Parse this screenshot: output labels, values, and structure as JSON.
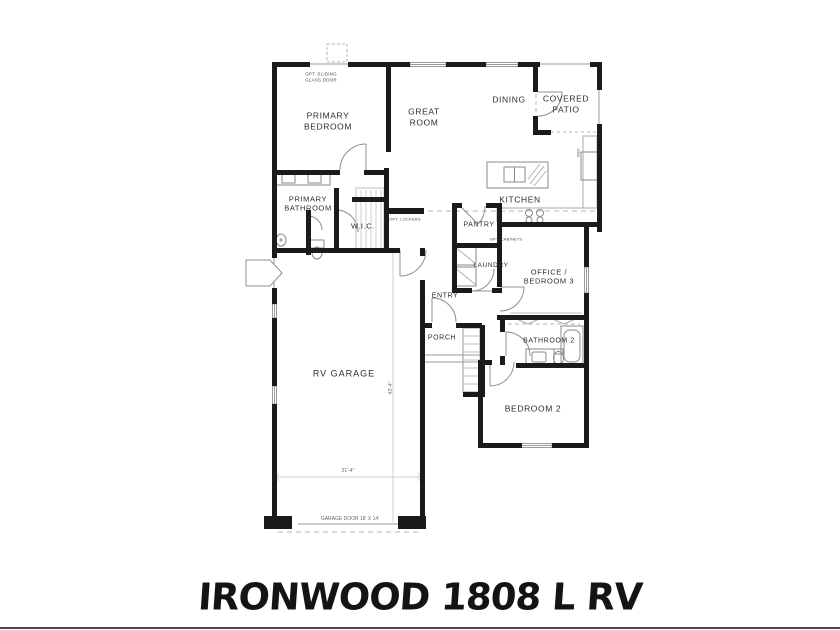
{
  "title": "IRONWOOD 1808 L RV",
  "rooms": {
    "primary_bedroom": "PRIMARY\nBEDROOM",
    "great_room": "GREAT\nROOM",
    "dining": "DINING",
    "covered_patio": "COVERED\nPATIO",
    "kitchen": "KITCHEN",
    "primary_bathroom": "PRIMARY\nBATHROOM",
    "wic": "W.I.C.",
    "pantry": "PANTRY",
    "laundry": "LAUNDRY",
    "office_bedroom3": "OFFICE /\nBEDROOM 3",
    "entry": "ENTRY",
    "porch": "PORCH",
    "bathroom2": "BATHROOM 2",
    "bedroom2": "BEDROOM 2",
    "rv_garage": "RV GARAGE"
  },
  "annotations": {
    "opt_sliding_glass_door": "OPT. SLIDING\nGLASS DOOR",
    "opt_lockers": "OPT. LOCKERS",
    "opt_cabinets": "OPT. CABINETS",
    "ref_label": "REF.",
    "garage_door_label": "GARAGE DOOR 18' X 14'",
    "garage_width_dim": "21'-4\"",
    "garage_depth_dim": "43'-4\""
  },
  "colors": {
    "wall": "#1b1b1b",
    "thin_line": "#9a9a9a",
    "dash_line": "#b5b5b5",
    "text": "#2e2e2e"
  }
}
